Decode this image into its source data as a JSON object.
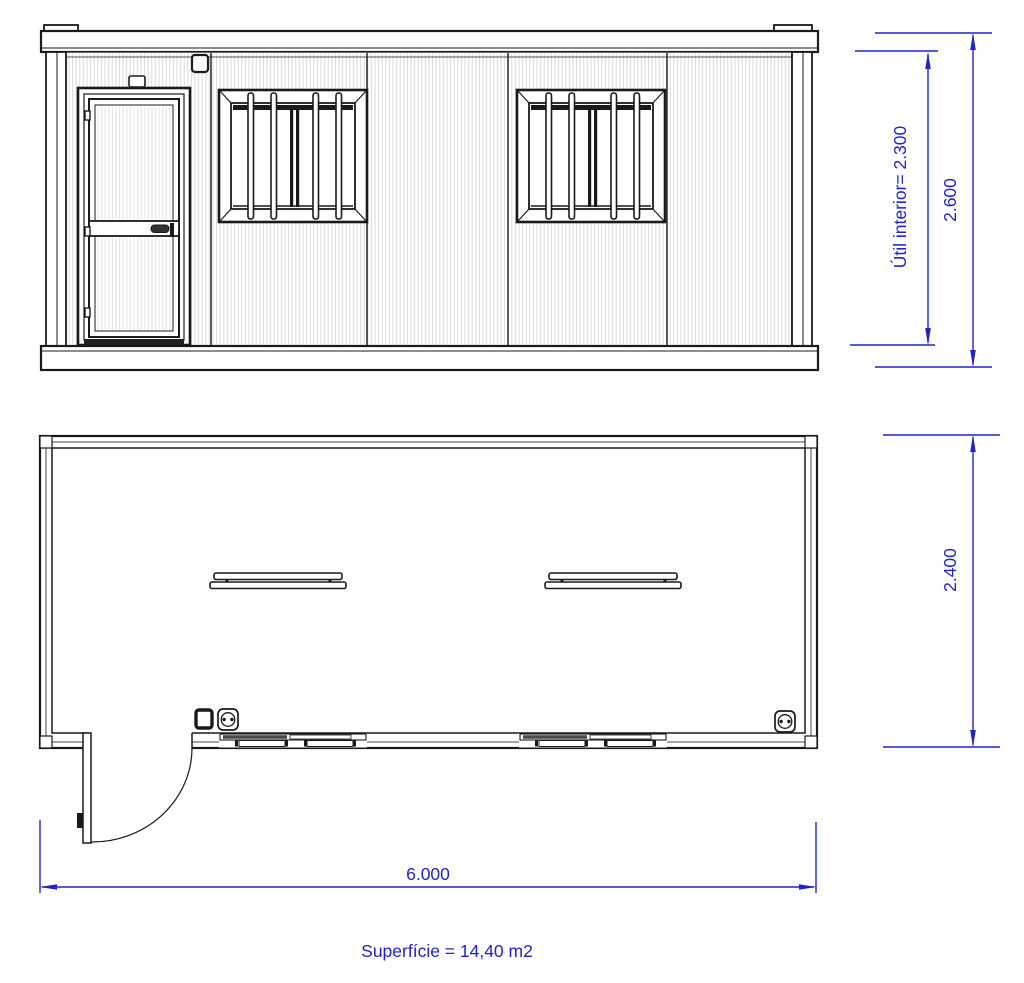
{
  "page": {
    "background": "#ffffff"
  },
  "colors": {
    "dimension": "#2222cc",
    "line": "#1a1a1a",
    "corrugation": "#dadada",
    "glazing": "#4a4a4a"
  },
  "elevation": {
    "labels": {
      "interior_height": "Útil interior= 2.300",
      "overall_height": "2.600"
    }
  },
  "plan": {
    "labels": {
      "depth": "2.400",
      "overall_width": "6.000",
      "area": "Superfície = 14,40 m2"
    }
  }
}
